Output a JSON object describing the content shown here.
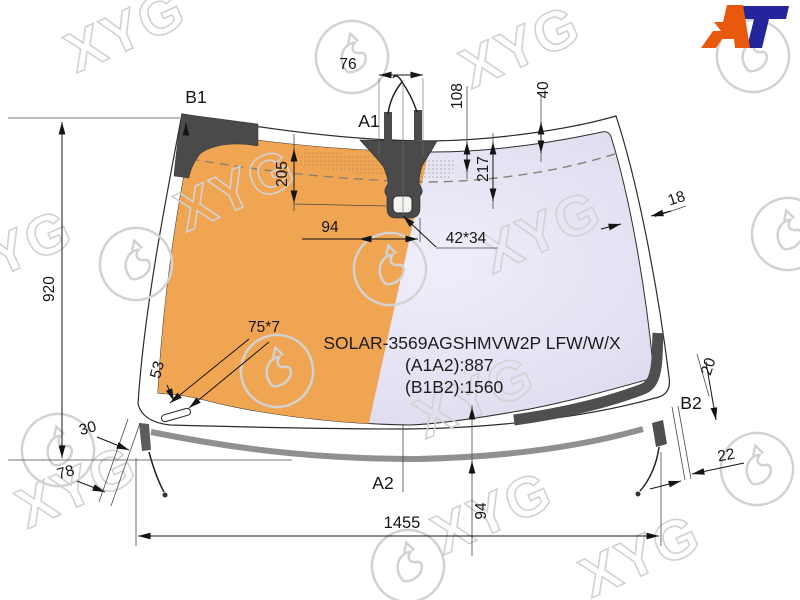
{
  "branding": {
    "watermark": "XYG",
    "logo": {
      "a": "A",
      "t": "T"
    }
  },
  "part": {
    "model": "SOLAR-3569AGSHMVW2P LFW/W/X",
    "a1a2": "(A1A2):887",
    "b1b2": "(B1B2):1560"
  },
  "anchors": {
    "b1": "B1",
    "a1": "A1",
    "b2": "B2",
    "a2": "A2"
  },
  "dims": {
    "w76": "76",
    "h108": "108",
    "h40": "40",
    "h205": "205",
    "h217": "217",
    "w94_top": "94",
    "hole": "42*34",
    "e18": "18",
    "h920": "920",
    "s75x7": "75*7",
    "s53": "53",
    "e30": "30",
    "e78": "78",
    "w1455": "1455",
    "h94_bottom": "94",
    "e20": "20",
    "e22": "22"
  },
  "colors": {
    "glass_left": "#F0A553",
    "glass_right": "#DEDCEF",
    "frit_band": "#4A4A4A",
    "molding": "#8F8F8F",
    "logo_orange": "#E8590D",
    "logo_blue": "#24249C",
    "watermark": "#D2D2D2"
  }
}
